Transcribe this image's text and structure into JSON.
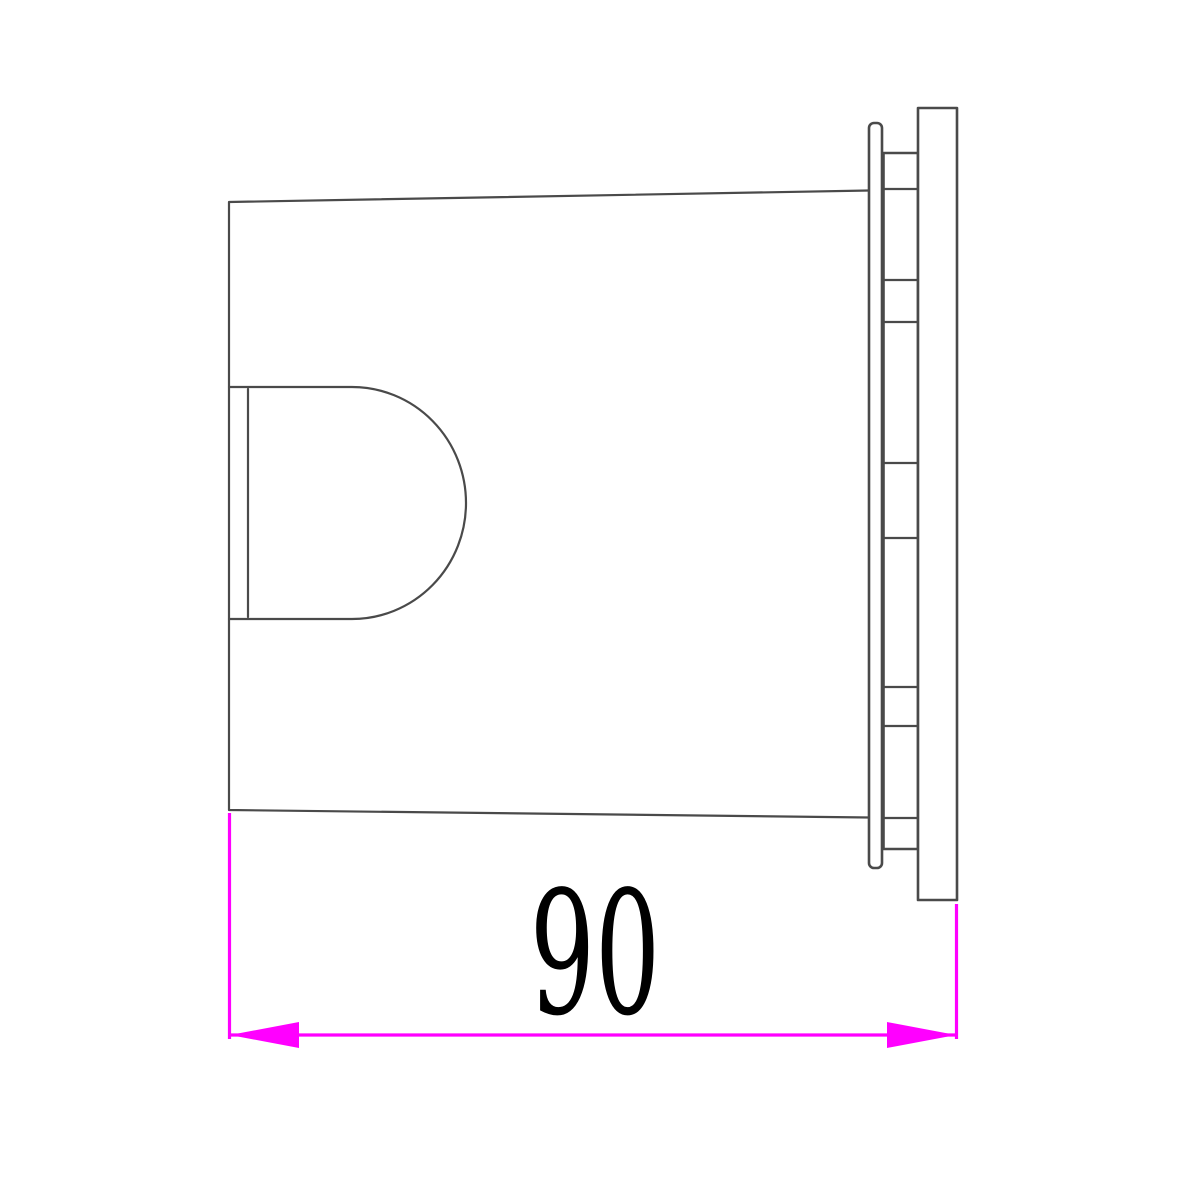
{
  "drawing": {
    "dimension_label": "90"
  },
  "colors": {
    "line": "#4a4a4a",
    "dimension": "#ff00ff",
    "label": "#000000",
    "background": "#ffffff"
  }
}
